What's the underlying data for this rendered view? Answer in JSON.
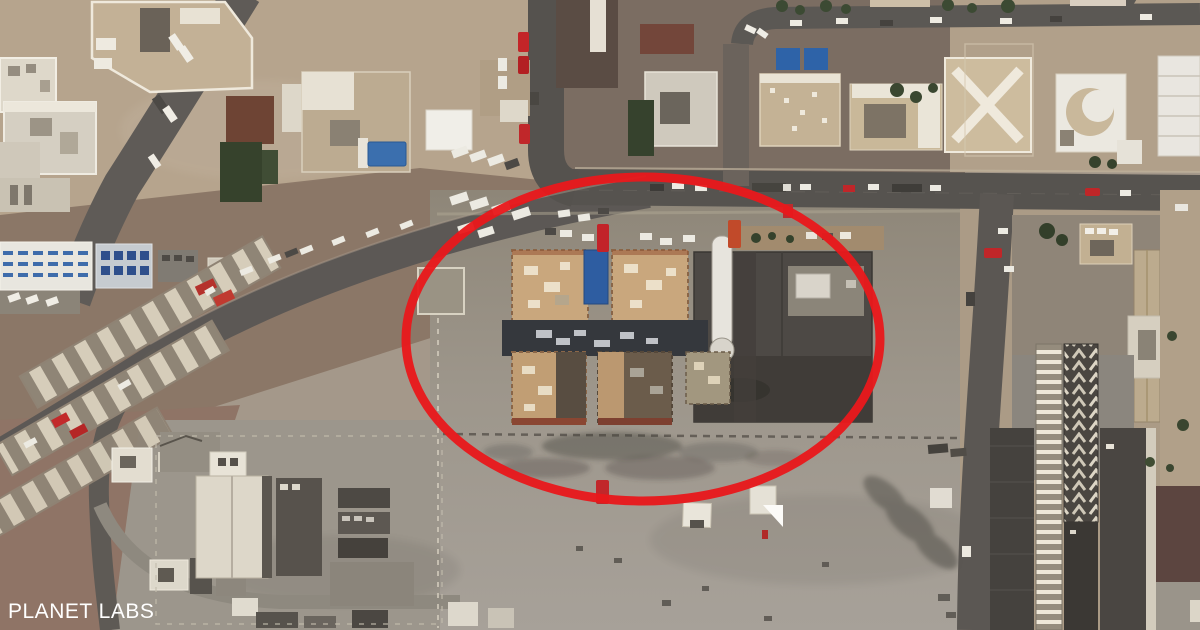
{
  "scene": {
    "type": "satellite-photo",
    "description": "Satellite view of a desert city block with roads, villas, warehouses and a damaged building compound circled in red",
    "width_px": 1200,
    "height_px": 630
  },
  "watermark": {
    "label": "PLANET LABS",
    "color": "#ffffff"
  },
  "annotation": {
    "shape": "ellipse",
    "color": "#e8191c",
    "center_x": 643,
    "center_y": 339,
    "radius_x": 237,
    "radius_y": 162,
    "stroke_width": 9
  },
  "palette": {
    "sand": "#b6a48d",
    "earth": "#8b7767",
    "dirt": "#8f7466",
    "asphalt": "#5b5753",
    "concrete": "#a09a91",
    "building_tan": "#c9a77d",
    "building_white": "#e9e6df",
    "burned": "#35383d",
    "pool_blue": "#2e5da1",
    "vegetation": "#36422c",
    "vehicle_red": "#c22329"
  }
}
